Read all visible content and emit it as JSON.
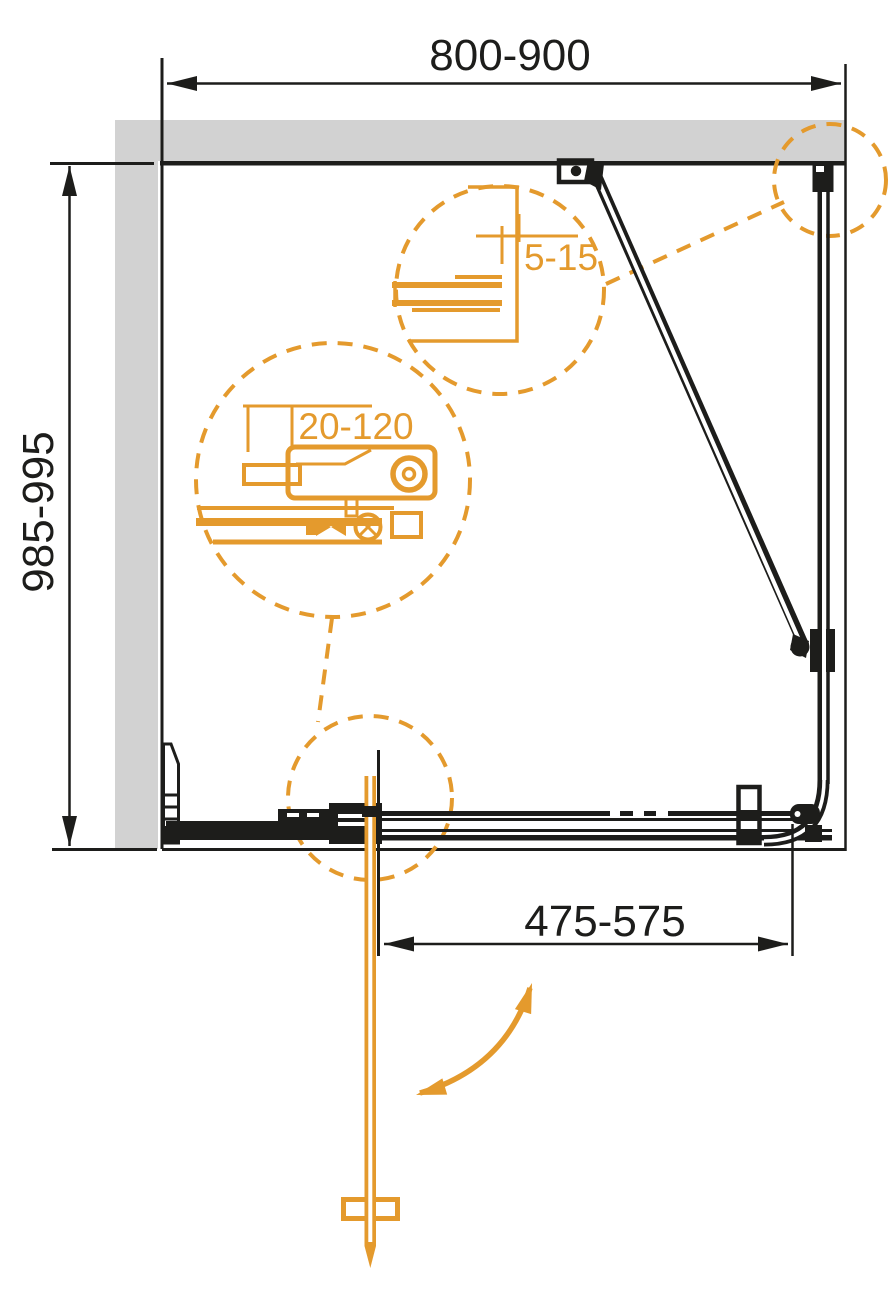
{
  "diagram_labels": {
    "width_range": "800-900",
    "depth_range": "985-995",
    "door_offset_range": "475-575",
    "wall_gap_range": "5-15",
    "profile_adjust_range": "20-120"
  },
  "colors": {
    "line_black": "#1d1d1b",
    "accent_orange": "#e49a2d",
    "wall_gray": "#d2d2d2",
    "background": "#ffffff"
  }
}
